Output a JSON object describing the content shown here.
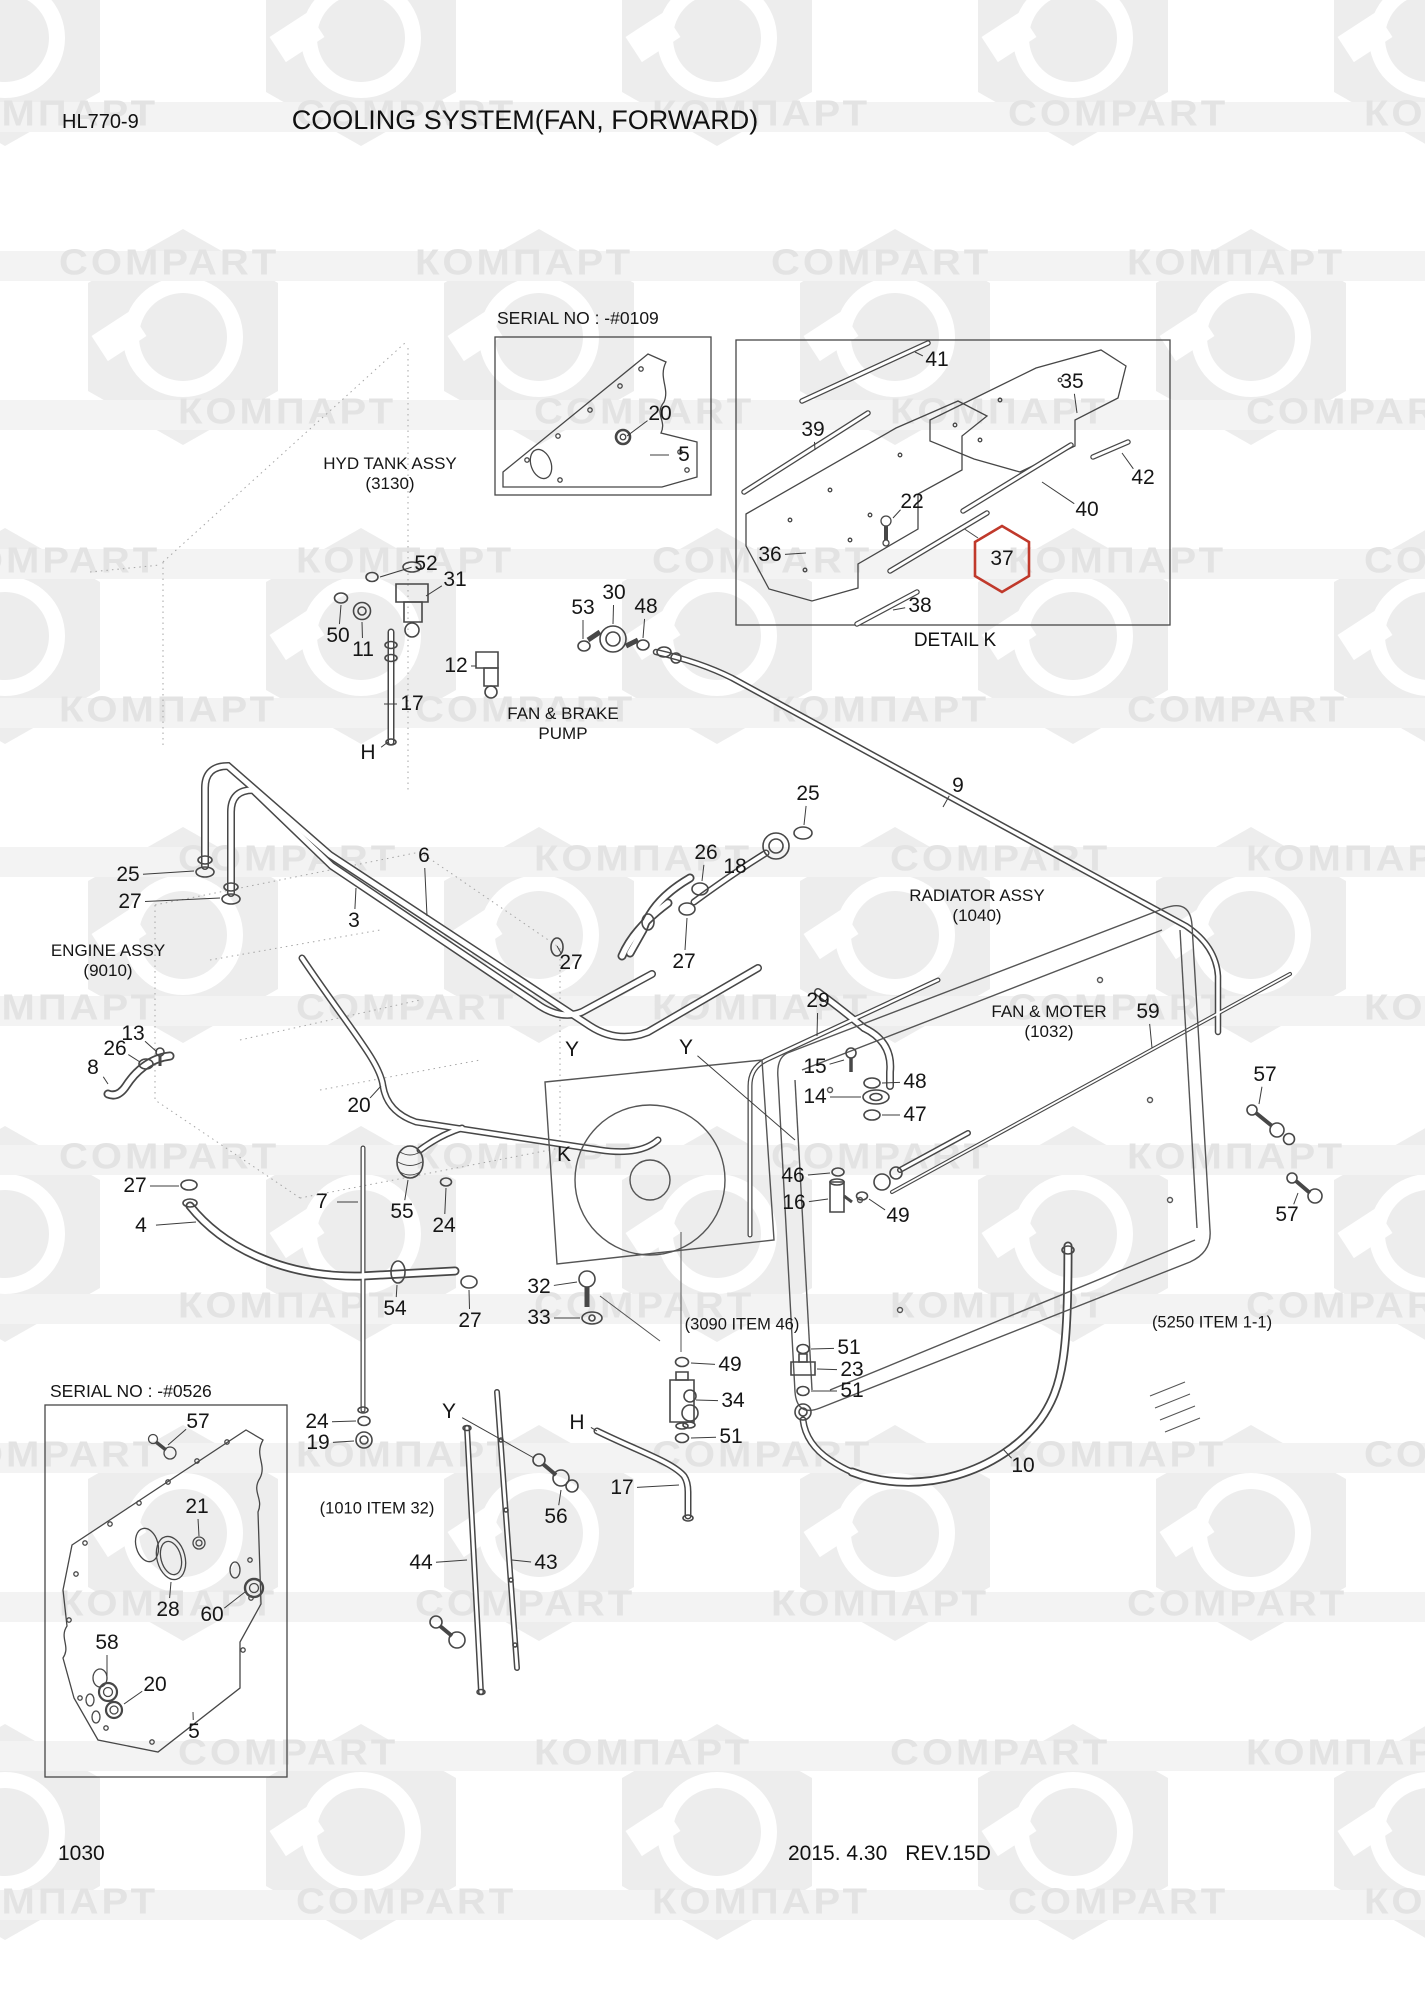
{
  "page": {
    "model": "HL770-9",
    "title": "COOLING SYSTEM(FAN, FORWARD)",
    "page_number": "1030",
    "revision_date": "2015. 4.30",
    "revision": "REV.15D"
  },
  "watermark": {
    "latin": "COMPART",
    "cyrillic": "КОМПАРТ"
  },
  "insets": {
    "serial_top": "SERIAL NO : -#0109",
    "serial_bottom": "SERIAL NO : -#0526",
    "detail_caption": "DETAIL K"
  },
  "highlight_color": "#c0392b",
  "assembly_labels": [
    {
      "name": "hyd-tank-assy",
      "line1": "HYD TANK ASSY",
      "line2": "(3130)",
      "x": 390,
      "y": 474
    },
    {
      "name": "fan-brake-pump",
      "line1": "FAN & BRAKE",
      "line2": "PUMP",
      "x": 563,
      "y": 724
    },
    {
      "name": "engine-assy",
      "line1": "ENGINE ASSY",
      "line2": "(9010)",
      "x": 108,
      "y": 961
    },
    {
      "name": "radiator-assy",
      "line1": "RADIATOR ASSY",
      "line2": "(1040)",
      "x": 977,
      "y": 906
    },
    {
      "name": "fan-moter",
      "line1": "FAN & MOTER",
      "line2": "(1032)",
      "x": 1049,
      "y": 1022
    }
  ],
  "ref_notes": [
    {
      "text": "(3090 ITEM 46)",
      "x": 742,
      "y": 1325
    },
    {
      "text": "(5250 ITEM 1-1)",
      "x": 1212,
      "y": 1323
    },
    {
      "text": "(1010 ITEM 32)",
      "x": 377,
      "y": 1509
    }
  ],
  "callouts": [
    {
      "t": "20",
      "x": 660,
      "y": 414,
      "l": [
        627,
        436
      ]
    },
    {
      "t": "5",
      "x": 684,
      "y": 455,
      "l": [
        650,
        455
      ]
    },
    {
      "t": "41",
      "x": 937,
      "y": 360,
      "l": [
        915,
        352
      ]
    },
    {
      "t": "35",
      "x": 1072,
      "y": 382,
      "l": [
        1077,
        413
      ]
    },
    {
      "t": "39",
      "x": 813,
      "y": 430,
      "l": [
        815,
        450
      ]
    },
    {
      "t": "22",
      "x": 912,
      "y": 502,
      "l": [
        893,
        518
      ]
    },
    {
      "t": "42",
      "x": 1143,
      "y": 478,
      "l": [
        1122,
        453
      ]
    },
    {
      "t": "40",
      "x": 1087,
      "y": 510,
      "l": [
        1042,
        482
      ]
    },
    {
      "t": "36",
      "x": 770,
      "y": 555,
      "l": [
        806,
        553
      ]
    },
    {
      "t": "37",
      "x": 1002,
      "y": 559,
      "hl": true
    },
    {
      "t": "38",
      "x": 920,
      "y": 606,
      "l": [
        893,
        610
      ]
    },
    {
      "t": "52",
      "x": 426,
      "y": 564,
      "l": [
        380,
        577
      ]
    },
    {
      "t": "31",
      "x": 455,
      "y": 580,
      "l": [
        426,
        596
      ]
    },
    {
      "t": "50",
      "x": 338,
      "y": 636,
      "l": [
        341,
        605
      ]
    },
    {
      "t": "11",
      "x": 363,
      "y": 650,
      "l": [
        362,
        622
      ]
    },
    {
      "t": "12",
      "x": 456,
      "y": 666,
      "l": [
        476,
        666
      ]
    },
    {
      "t": "53",
      "x": 583,
      "y": 608,
      "l": [
        583,
        639
      ]
    },
    {
      "t": "30",
      "x": 614,
      "y": 593,
      "l": [
        613,
        624
      ]
    },
    {
      "t": "48",
      "x": 646,
      "y": 607,
      "l": [
        643,
        638
      ]
    },
    {
      "t": "17",
      "x": 412,
      "y": 704,
      "l": [
        384,
        704
      ]
    },
    {
      "t": "H",
      "x": 368,
      "y": 753,
      "l": [
        388,
        742
      ]
    },
    {
      "t": "25",
      "x": 128,
      "y": 875,
      "l": [
        194,
        871
      ]
    },
    {
      "t": "27",
      "x": 130,
      "y": 902,
      "l": [
        220,
        898
      ]
    },
    {
      "t": "6",
      "x": 424,
      "y": 856,
      "l": [
        427,
        916
      ]
    },
    {
      "t": "3",
      "x": 354,
      "y": 921,
      "l": [
        356,
        888
      ]
    },
    {
      "t": "27",
      "x": 571,
      "y": 963,
      "l": [
        557,
        946
      ]
    },
    {
      "t": "25",
      "x": 808,
      "y": 794,
      "l": [
        804,
        825
      ]
    },
    {
      "t": "9",
      "x": 958,
      "y": 786,
      "l": [
        943,
        807
      ]
    },
    {
      "t": "26",
      "x": 706,
      "y": 853,
      "l": [
        702,
        881
      ]
    },
    {
      "t": "18",
      "x": 735,
      "y": 867,
      "l": [
        762,
        852
      ]
    },
    {
      "t": "27",
      "x": 684,
      "y": 962,
      "l": [
        687,
        918
      ]
    },
    {
      "t": "13",
      "x": 133,
      "y": 1034,
      "l": [
        157,
        1052
      ]
    },
    {
      "t": "26",
      "x": 115,
      "y": 1049,
      "l": [
        140,
        1062
      ]
    },
    {
      "t": "8",
      "x": 93,
      "y": 1068,
      "l": [
        108,
        1084
      ]
    },
    {
      "t": "20",
      "x": 359,
      "y": 1106,
      "l": [
        381,
        1086
      ]
    },
    {
      "t": "Y",
      "x": 572,
      "y": 1050
    },
    {
      "t": "Y",
      "x": 686,
      "y": 1048,
      "l": [
        795,
        1140
      ]
    },
    {
      "t": "K",
      "x": 564,
      "y": 1155
    },
    {
      "t": "29",
      "x": 818,
      "y": 1001,
      "l": [
        817,
        1036
      ]
    },
    {
      "t": "15",
      "x": 815,
      "y": 1067,
      "l": [
        844,
        1060
      ]
    },
    {
      "t": "48",
      "x": 915,
      "y": 1082,
      "l": [
        882,
        1083
      ]
    },
    {
      "t": "14",
      "x": 815,
      "y": 1097,
      "l": [
        861,
        1097
      ]
    },
    {
      "t": "47",
      "x": 915,
      "y": 1115,
      "l": [
        882,
        1115
      ]
    },
    {
      "t": "46",
      "x": 793,
      "y": 1176,
      "l": [
        830,
        1173
      ]
    },
    {
      "t": "16",
      "x": 794,
      "y": 1203,
      "l": [
        828,
        1199
      ]
    },
    {
      "t": "49",
      "x": 898,
      "y": 1216,
      "l": [
        869,
        1199
      ]
    },
    {
      "t": "59",
      "x": 1148,
      "y": 1012,
      "l": [
        1152,
        1048
      ]
    },
    {
      "t": "57",
      "x": 1265,
      "y": 1075,
      "l": [
        1259,
        1104
      ]
    },
    {
      "t": "57",
      "x": 1287,
      "y": 1215,
      "l": [
        1298,
        1193
      ]
    },
    {
      "t": "10",
      "x": 1023,
      "y": 1466,
      "l": [
        1003,
        1449
      ]
    },
    {
      "t": "27",
      "x": 135,
      "y": 1186,
      "l": [
        179,
        1186
      ]
    },
    {
      "t": "4",
      "x": 141,
      "y": 1226,
      "l": [
        196,
        1222
      ]
    },
    {
      "t": "7",
      "x": 322,
      "y": 1202,
      "l": [
        358,
        1202
      ]
    },
    {
      "t": "55",
      "x": 402,
      "y": 1212,
      "l": [
        408,
        1180
      ]
    },
    {
      "t": "24",
      "x": 444,
      "y": 1226,
      "l": [
        446,
        1188
      ]
    },
    {
      "t": "54",
      "x": 395,
      "y": 1309,
      "l": [
        397,
        1285
      ]
    },
    {
      "t": "27",
      "x": 470,
      "y": 1321,
      "l": [
        469,
        1290
      ]
    },
    {
      "t": "32",
      "x": 539,
      "y": 1287,
      "l": [
        577,
        1282
      ]
    },
    {
      "t": "33",
      "x": 539,
      "y": 1318,
      "l": [
        580,
        1318
      ]
    },
    {
      "t": "49",
      "x": 730,
      "y": 1365,
      "l": [
        691,
        1363
      ]
    },
    {
      "t": "34",
      "x": 733,
      "y": 1401,
      "l": [
        696,
        1400
      ]
    },
    {
      "t": "51",
      "x": 731,
      "y": 1437,
      "l": [
        691,
        1438
      ]
    },
    {
      "t": "51",
      "x": 849,
      "y": 1348,
      "l": [
        811,
        1349
      ]
    },
    {
      "t": "23",
      "x": 852,
      "y": 1370,
      "l": [
        817,
        1369
      ]
    },
    {
      "t": "51",
      "x": 852,
      "y": 1391,
      "l": [
        811,
        1391
      ]
    },
    {
      "t": "24",
      "x": 317,
      "y": 1422,
      "l": [
        356,
        1421
      ]
    },
    {
      "t": "19",
      "x": 318,
      "y": 1443,
      "l": [
        354,
        1441
      ]
    },
    {
      "t": "56",
      "x": 556,
      "y": 1517,
      "l": [
        561,
        1490
      ]
    },
    {
      "t": "Y",
      "x": 449,
      "y": 1412,
      "l": [
        534,
        1458
      ]
    },
    {
      "t": "H",
      "x": 577,
      "y": 1423,
      "l": [
        597,
        1431
      ]
    },
    {
      "t": "17",
      "x": 622,
      "y": 1488,
      "l": [
        679,
        1485
      ]
    },
    {
      "t": "44",
      "x": 421,
      "y": 1563,
      "l": [
        467,
        1560
      ]
    },
    {
      "t": "43",
      "x": 546,
      "y": 1563,
      "l": [
        512,
        1560
      ]
    },
    {
      "t": "57",
      "x": 198,
      "y": 1422,
      "l": [
        168,
        1445
      ]
    },
    {
      "t": "21",
      "x": 197,
      "y": 1507,
      "l": [
        199,
        1536
      ]
    },
    {
      "t": "28",
      "x": 168,
      "y": 1610,
      "l": [
        171,
        1582
      ]
    },
    {
      "t": "60",
      "x": 212,
      "y": 1615,
      "l": [
        245,
        1592
      ]
    },
    {
      "t": "58",
      "x": 107,
      "y": 1643,
      "l": [
        107,
        1680
      ]
    },
    {
      "t": "20",
      "x": 155,
      "y": 1685,
      "l": [
        124,
        1704
      ]
    },
    {
      "t": "5",
      "x": 194,
      "y": 1732,
      "l": [
        193,
        1712
      ]
    }
  ]
}
